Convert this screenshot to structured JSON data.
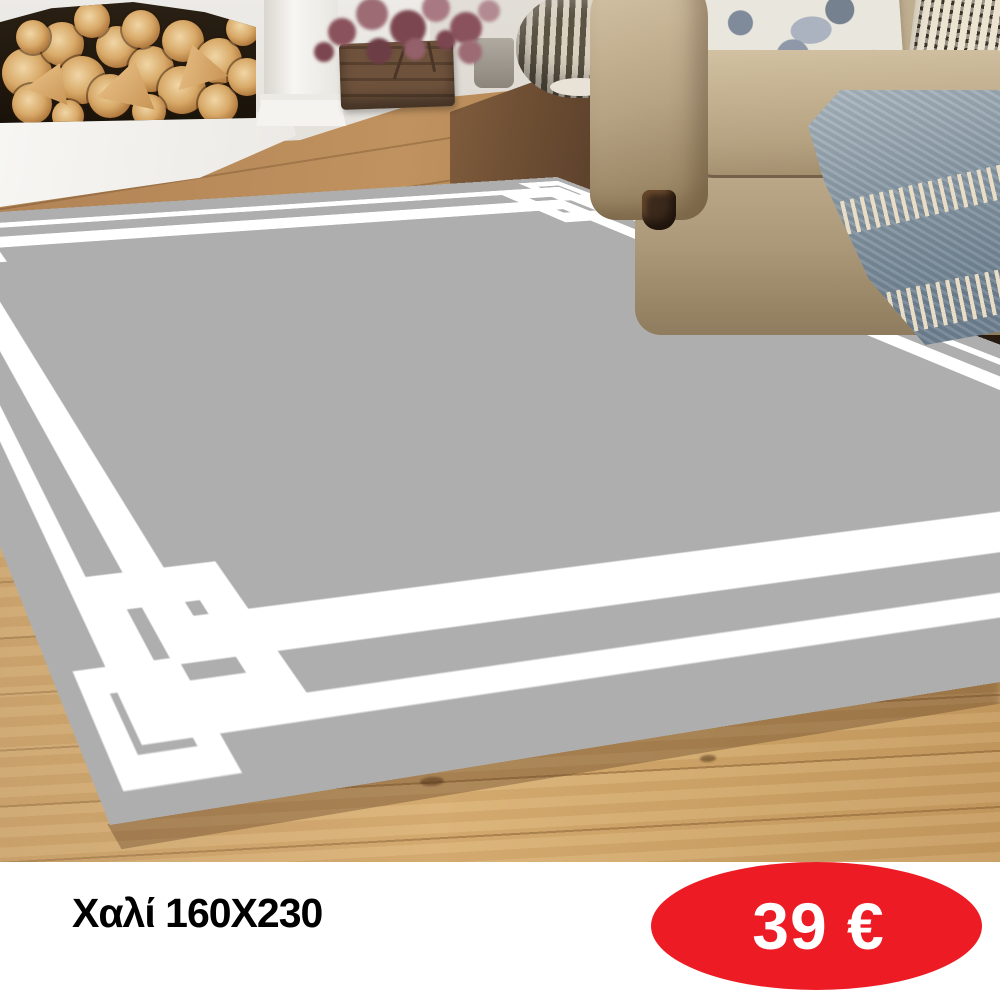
{
  "caption": {
    "title": "Χαλί 160X230",
    "price": "39 €"
  },
  "colors": {
    "price_badge": "#ed1c24",
    "price_text": "#ffffff",
    "title_text": "#000000",
    "rug": "#aeaeae",
    "rug_border": "#ffffff",
    "caption_background": "#ffffff"
  }
}
